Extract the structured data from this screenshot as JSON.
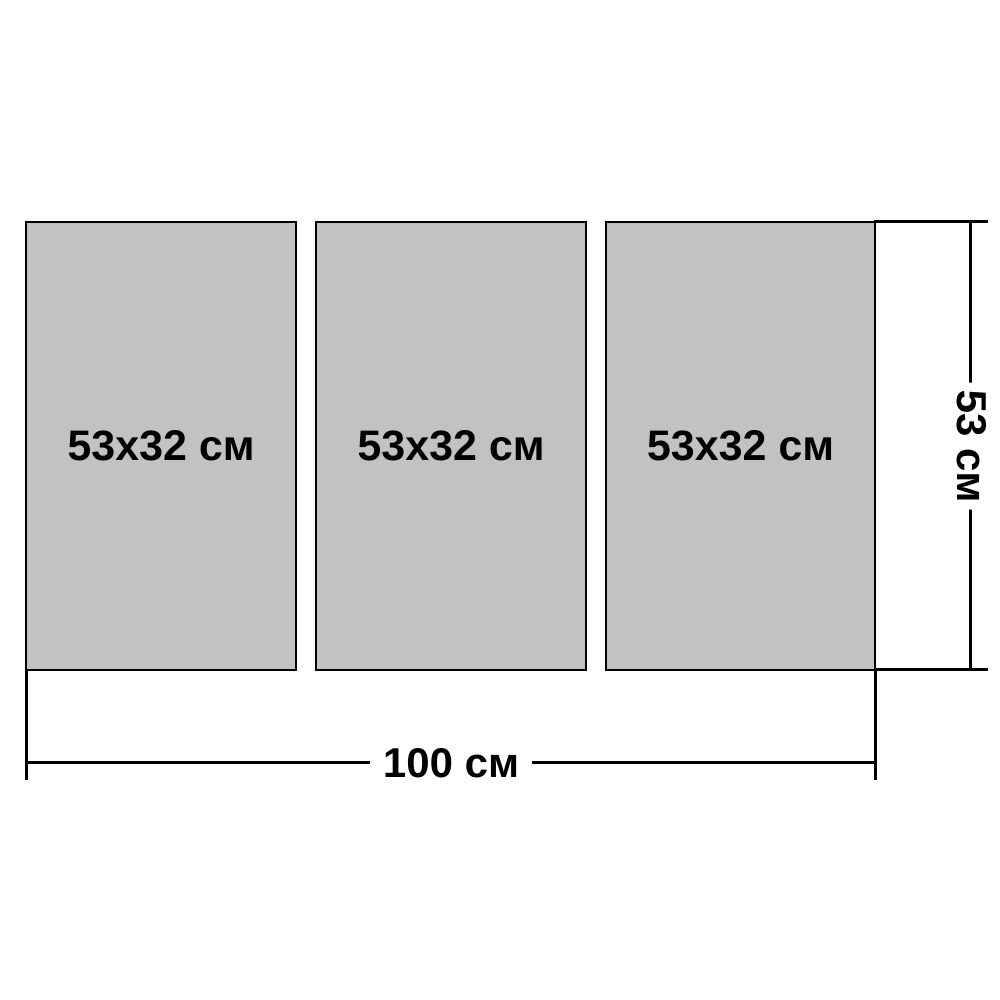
{
  "figure": {
    "title": "modular-painting-size-diagram",
    "panels": [
      {
        "label": "53x32 см"
      },
      {
        "label": "53x32 см"
      },
      {
        "label": "53x32 см"
      }
    ],
    "width_dimension": {
      "label": "100 см"
    },
    "height_dimension": {
      "label": "53 см"
    },
    "colors": {
      "background": "#ffffff",
      "panel_fill": "#c2c2c2",
      "panel_border": "#000000",
      "dimension_line": "#000000",
      "text": "#000000"
    }
  }
}
